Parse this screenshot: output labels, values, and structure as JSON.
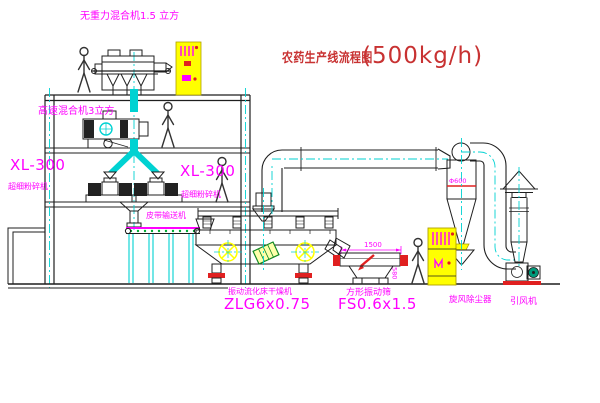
{
  "title": {
    "name_cn": "农药生产线流程图",
    "capacity": "(500kg/h)"
  },
  "labels": {
    "gravity_mixer": "无重力混合机1.5 立方",
    "high_speed_mixer": "高速混合机3立方",
    "mill_model_left": "XL-300",
    "mill_name_left": "超细粉碎机",
    "mill_model_right": "XL-300",
    "mill_name_right": "超细粉碎机",
    "belt_conveyor": "皮带输送机",
    "dryer_name": "振动流化床干燥机",
    "dryer_model": "ZLG6x0.75",
    "screen_name": "方形振动筛",
    "screen_model": "FS0.6x1.5",
    "cyclone": "旋风除尘器",
    "fan": "引风机"
  },
  "dimensions": {
    "screen_length": "1500",
    "screen_height": "580",
    "cyclone_diameter": "Φ600"
  },
  "colors": {
    "line": "#1f1f1f",
    "centerline_cyan": "#00d2d2",
    "label_magenta": "#ff00ff",
    "accent_red": "#e02020",
    "cabinet_yellow": "#ffff00",
    "conveyor_green": "#00aa33",
    "title_red": "#c83232"
  }
}
